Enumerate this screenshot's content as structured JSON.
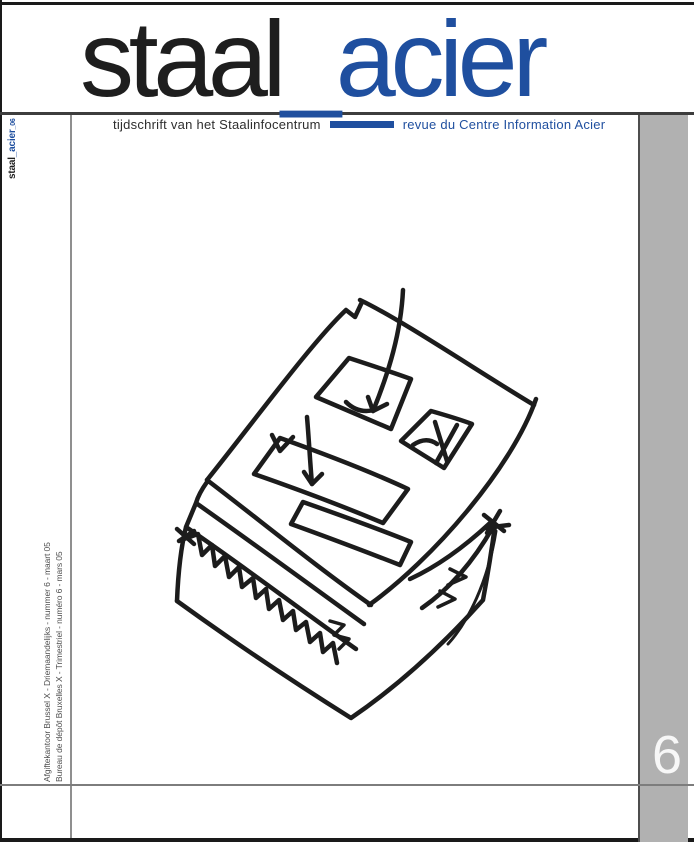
{
  "cover": {
    "masthead": {
      "title_black": "staal",
      "title_blue": "_acier",
      "subtitle_nl": "tijdschrift van het Staalinfocentrum",
      "subtitle_fr": "revue du Centre Information Acier"
    },
    "spine": {
      "black": "staal",
      "blue": "_acier",
      "issue_suffix": "_06"
    },
    "imprint": {
      "nl": "Afgiftekantoor Brussel X - Driemaandelijks - nummer 6 - maart 05",
      "fr": "Bureau de dépôt Bruxelles X - Trimestriel - numéro 6 - mars 05"
    },
    "issue_number": "6",
    "colors": {
      "accent_blue": "#1f4f9f",
      "ink": "#1c1c1c",
      "column_gray": "#b1b1b1"
    }
  }
}
